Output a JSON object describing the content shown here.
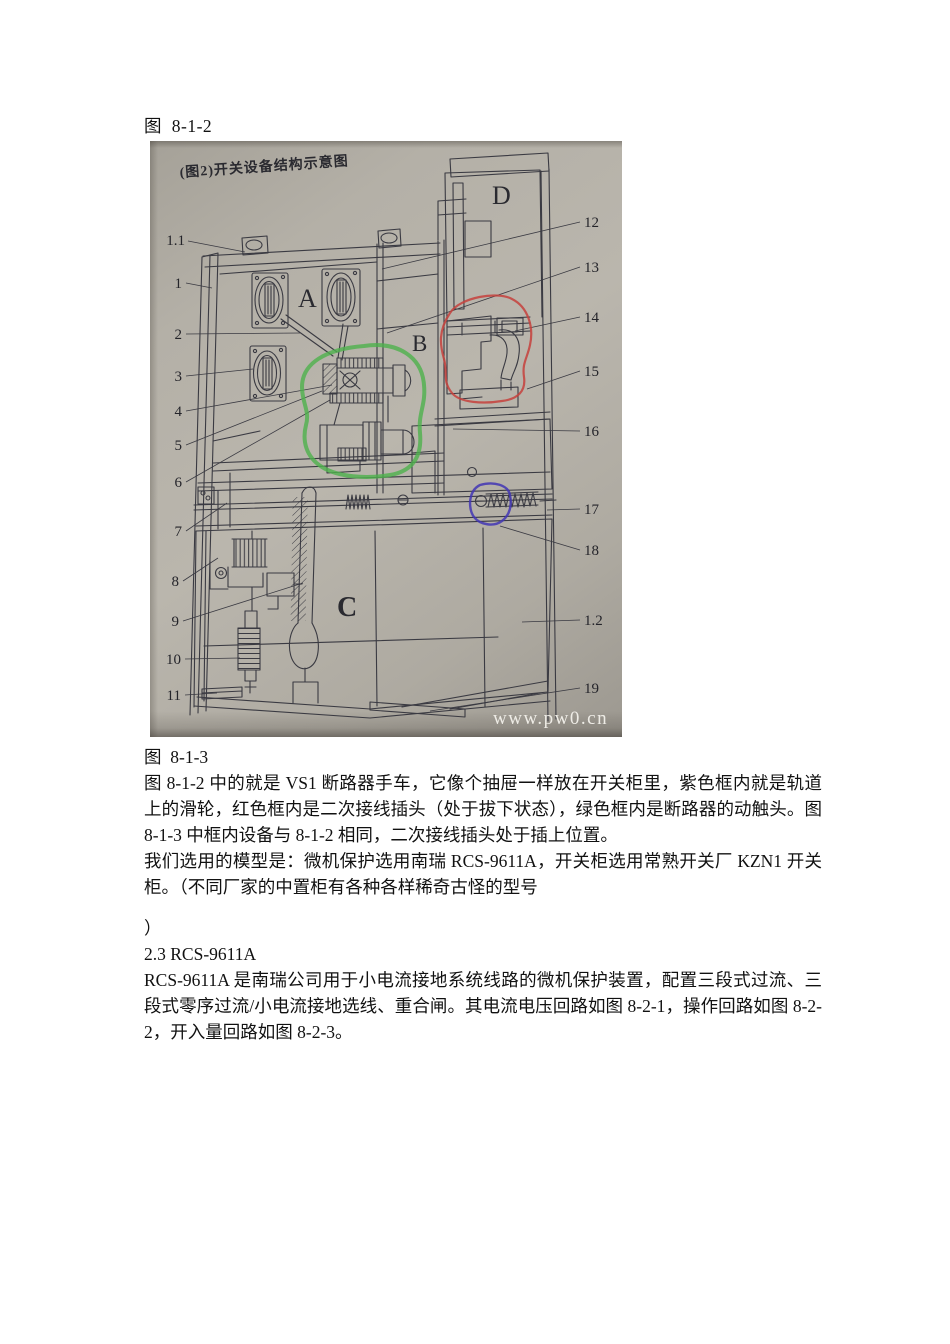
{
  "page": {
    "caption_top": "图  8-1-2",
    "figure_caption": "图  8-1-3",
    "para1": "图 8-1-2 中的就是 VS1 断路器手车，它像个抽屉一样放在开关柜里，紫色框内就是轨道上的滑轮，红色框内是二次接线插头（处于拔下状态），绿色框内是断路器的动触头。图  8-1-3 中框内设备与 8-1-2 相同，二次接线插头处于插上位置。",
    "para2": "我们选用的模型是：微机保护选用南瑞 RCS-9611A，开关柜选用常熟开关厂 KZN1 开关柜。（不同厂家的中置柜有各种各样稀奇古怪的型号",
    "paren_close": "）",
    "heading": "2.3 RCS-9611A",
    "para3": "RCS-9611A  是南瑞公司用于小电流接地系统线路的微机保护装置，配置三段式过流、三段式零序过流/小电流接地选线、重合闸。其电流电压回路如图  8-2-1，操作回路如图  8-2-2，开入量回路如图 8-2-3。"
  },
  "figure": {
    "title": "(图2)开关设备结构示意图",
    "watermark": "www.pw0.cn",
    "letters": {
      "a": "A",
      "b": "B",
      "c": "C",
      "d": "D"
    },
    "callouts_left": [
      "1.1",
      "1",
      "2",
      "3",
      "4",
      "5",
      "6",
      "7",
      "8",
      "9",
      "10",
      "11"
    ],
    "callouts_right": [
      "12",
      "13",
      "14",
      "15",
      "16",
      "17",
      "18",
      "1.2",
      "19"
    ],
    "annotation_colors": {
      "red": "#c5413c",
      "green": "#4eb14c",
      "purple": "#4236b4"
    }
  }
}
